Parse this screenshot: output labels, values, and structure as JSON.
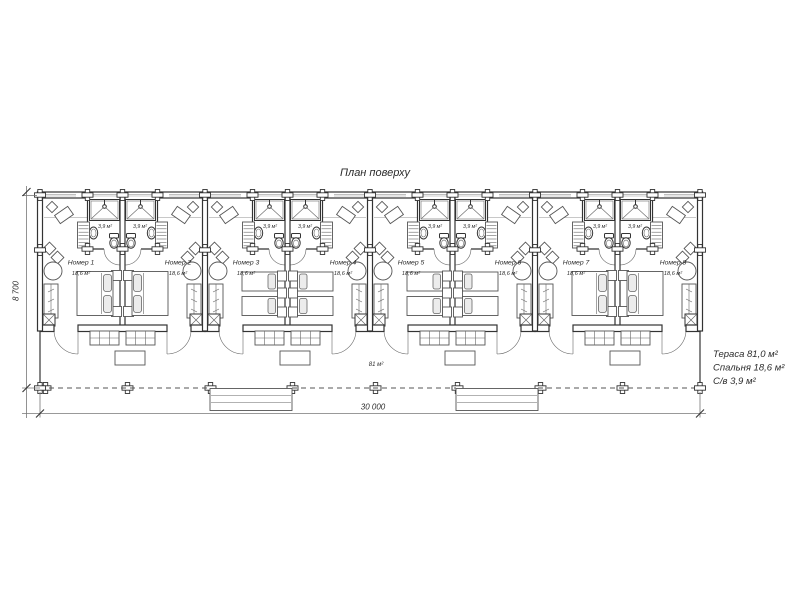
{
  "title": "План поверху",
  "legend": {
    "lines": [
      "Тераса 81,0 м²",
      "Спальня 18,6 м²",
      "С/в 3,9 м²"
    ]
  },
  "dimensions": {
    "width_label": "30 000",
    "depth_label": "8 700"
  },
  "terrace": {
    "area_label": "81 м²"
  },
  "bath_area_label": "3,9 м²",
  "rooms": [
    {
      "name": "Номер 1",
      "area": "18,6 м²",
      "bed": "double"
    },
    {
      "name": "Номер 2",
      "area": "18,6 м²",
      "bed": "double"
    },
    {
      "name": "Номер 3",
      "area": "18,6 м²",
      "bed": "twin"
    },
    {
      "name": "Номер 4",
      "area": "18,6 м²",
      "bed": "twin"
    },
    {
      "name": "Номер 5",
      "area": "18,6 м²",
      "bed": "twin"
    },
    {
      "name": "Номер 6",
      "area": "18,6 м²",
      "bed": "twin"
    },
    {
      "name": "Номер 7",
      "area": "18,6 м²",
      "bed": "double"
    },
    {
      "name": "Номер 8",
      "area": "18,6 м²",
      "bed": "double"
    }
  ],
  "colors": {
    "line": "#333333",
    "furniture": "#555555",
    "background": "#ffffff",
    "loft_line": "#c8c8c8"
  }
}
